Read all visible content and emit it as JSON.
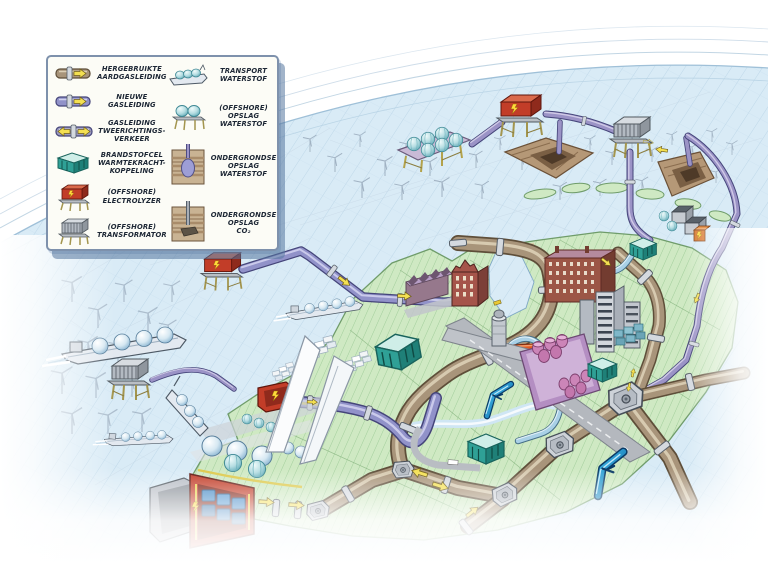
{
  "legend": {
    "left": [
      {
        "icon": "reused-gas-pipeline-icon",
        "label": "HERGEBRUIKTE\nAARDGASLEIDING"
      },
      {
        "icon": "new-gas-pipeline-icon",
        "label": "NIEUWE\nGASLEIDING"
      },
      {
        "icon": "two-way-gas-pipeline-icon",
        "label": "GASLEIDING\nTWEERICHTINGS-\nVERKEER"
      },
      {
        "icon": "fuel-cell-chp-icon",
        "label": "BRANDSTOFCEL\nWARMTEKRACHT-\nKOPPELING"
      },
      {
        "icon": "offshore-electrolyzer-icon",
        "label": "(OFFSHORE)\nELECTROLYZER"
      },
      {
        "icon": "offshore-transformer-icon",
        "label": "(OFFSHORE)\nTRANSFORMATOR"
      }
    ],
    "right": [
      {
        "icon": "hydrogen-transport-ship-icon",
        "label": "TRANSPORT\nWATERSTOF"
      },
      {
        "icon": "offshore-hydrogen-storage-icon",
        "label": "(OFFSHORE)\nOPSLAG\nWATERSTOF"
      },
      {
        "icon": "underground-hydrogen-storage-icon",
        "label": "ONDERGRONDSE\nOPSLAG\nWATERSTOF"
      },
      {
        "icon": "underground-co2-storage-icon",
        "label": "ONDERGRONDSE\nOPSLAG\nCO₂"
      }
    ]
  },
  "map": {
    "features": [
      "offshore-wind-farm-north",
      "offshore-wind-farm-west",
      "offshore-hydrogen-storage-platform",
      "offshore-electrolyzer-platform-north",
      "offshore-electrolyzer-platform-west",
      "offshore-transformer-platform-north",
      "offshore-transformer-platform-west",
      "underground-storage-cutaway-1",
      "underground-storage-cutaway-2",
      "hydrogen-tanker-ship",
      "docked-tanker-ship",
      "port-container-terminal",
      "turbine-blade-yard",
      "storage-spheres",
      "hydrogen-storage-domes",
      "electrolyzer-building-port",
      "electrolyzer-building-large",
      "fuel-cell-chp-building",
      "brick-city-district",
      "high-rise-district",
      "chemical-plant",
      "water-tower",
      "airport-runway",
      "highway-road",
      "wadden-islands",
      "ijsselmeer-inlet",
      "pipeline-brown-trunk",
      "pipeline-new-purple",
      "pipeline-orange",
      "pipeline-blue",
      "pipeline-junction-node",
      "flow-arrow",
      "blue-bird-marker"
    ]
  },
  "colors": {
    "sea": "#d9ebf6",
    "sea_hatch": "#b7d3e6",
    "land": "#cfe9c3",
    "land_hatch": "#96c690",
    "pipe_brown": "#a8947a",
    "pipe_purple": "#9192c9",
    "pipe_blue": "#a9d0e6",
    "pipe_orange": "#e05a22",
    "arrow_yellow": "#f4e052",
    "electrolyzer_red": "#c23d28",
    "chp_teal": "#2fa096",
    "dome_teal": "#9fd4d8",
    "transformer_grey": "#b3bac2",
    "earth_brown": "#b59877",
    "bird_blue": "#1c8fd0"
  }
}
